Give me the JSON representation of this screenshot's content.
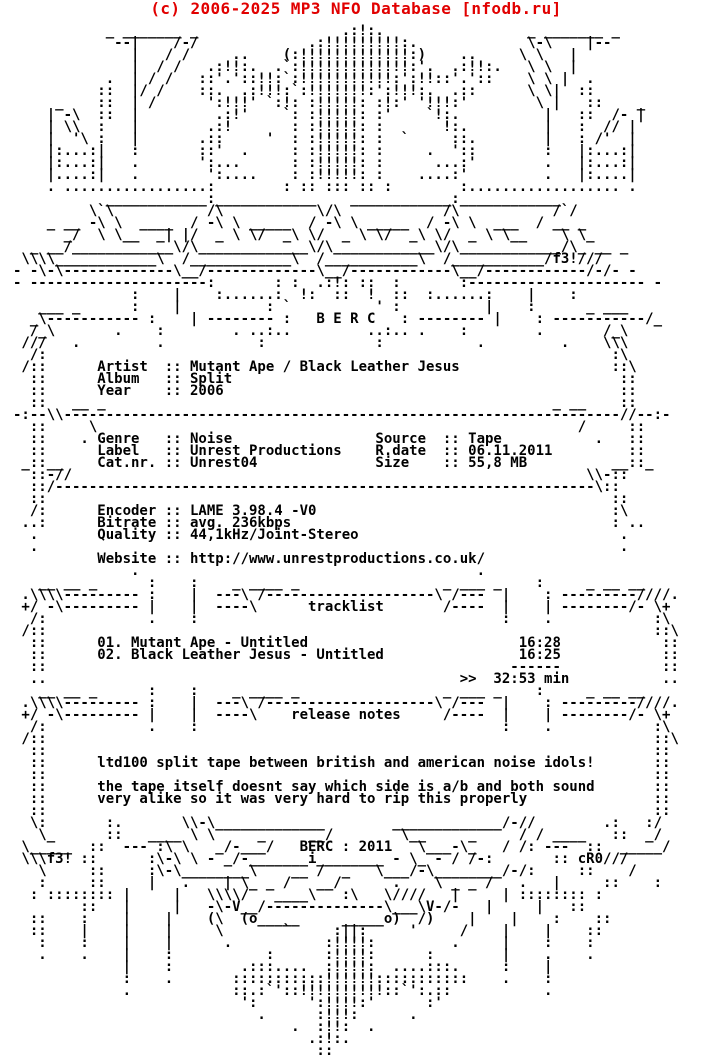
{
  "site_header": {
    "text": "(c) 2006-2025 MP3 NFO Database [nfodb.ru]",
    "color": "#e10000"
  },
  "group": {
    "name": "B E R C",
    "footer_tag": "BERC : 2011",
    "ascii_art_by": "f3!",
    "nfo_by": "cR0"
  },
  "release_info": {
    "artist": "Mutant Ape / Black Leather Jesus",
    "album": "Split",
    "year": "2006",
    "genre": "Noise",
    "label": "Unrest Productions",
    "cat_nr": "Unrest04",
    "source": "Tape",
    "release_date": "06.11.2011",
    "size": "55,8 MB",
    "encoder": "LAME 3.98.4 -V0",
    "bitrate": "avg. 236kbps",
    "quality": "44,1kHz/Joint-Stereo",
    "website": "http://www.unrestproductions.co.uk/"
  },
  "tracklist": {
    "section_title": "tracklist",
    "tracks": [
      {
        "number": "01.",
        "title": "Mutant Ape - Untitled",
        "duration": "16:28"
      },
      {
        "number": "02.",
        "title": "Black Leather Jesus - Untitled",
        "duration": "16:25"
      }
    ],
    "total_duration": "32:53 min"
  },
  "release_notes": {
    "section_title": "release notes",
    "lines": [
      "ltd100 split tape between british and american noise idols!",
      "the tape itself doesnt say which side is a/b and both sound",
      "very alike so it was very hard to rip this properly"
    ]
  },
  "nfo_ascii": [
    "           _ _______ _                 .:!:.                 _ _______ _",
    "            --|    /-/             .:!!!!!!!!!:.             \\-\\    |--",
    "              |   / /     ..    (:!!!!!!!!!!!!!:)    ..     \\ \\   |",
    "              |  / /   .:!!:.  .`:!!!!!!!!!!!!!:'.  .:!!:.   \\ \\  |",
    "           .  | / /   ::'.'::!!:`:!!!!!!!!!!!:':!!::'.'::    \\ \\ |  .",
    "          ::  |/ /    ::.  .:!!!:`:!!!!!!!:':!!!:.  .::      \\ \\|  ::",
    "     _    ::  | /      ':!!!' `:!: :!!!!!: :!:' '!!!:'        \\ |   ::    _",
    "    | -\\  ::  |         .:!'    `: :!!!!!: :'    `!:.          |   ::  /- |",
    "    | \\\\  :   |        .:!       : :!!!!!: :       !:.         |   :  // |",
    "    |  '\\ :   |       .::     '  : :!!!!!: :  `     ::.        |   : /'  |",
    "    |:...:|   :       ::'  .     : :!!!!!: :     .  '::        :   |:...:|",
    "    |:...:|   .       ':...      : :!!!!!: :      ...:'        .   |:...:|",
    "    |....:|   .        ':....    : :!!!!!: :    ....:'         .   |:....|",
    "    . .................:        : :: ::: :: :        :.................. .",
    "           ____________:____________    ____________:____________",
    "         \\`\\           /\\           \\/\\            /\\           /`/",
    "    _ __ -\\ \\  ____  / -\\ \\ _____  / -\\ \\ _____  / -\\ \\  ___  / __ _",
    "      _/  \\ \\__  _| |/  _ \\ \\/  _\\ \\/  _ \\ \\/  _\\ \\/  _ \\ \\__    \\ \\_",
    "  _ __/____________\\/\\_____________\\/\\____________\\/\\____________/\\_ __ _",
    " \\\\\\\\____________\\  /____________\\  /___________\\  /___________/f3!///",
    "- -\\-\\-------------\\__/-------------\\__/------------\\__/------------/-/- -",
    "- ---------------------:       : :  .:!: ::  :       :--------------------- -",
    "              :    |    :......:  !:  ::  !  ::  :......:    |    :",
    "   ___ _      :    |          : `          ' :          |    :      _ ___",
    "  _\\----------- :    | -------- :   B E R C   : -------- |    : -----------/_",
    "  /_\\       .    :        . ..:..         ..:.. .    :        .       /_\\",
    " ///   .         .           :             :           .         .    \\\\\\",
    "  /:                                                                   :\\",
    " /::      Artist  :: Mutant Ape / Black Leather Jesus                  ::\\",
    "  ::      Album   :: Split                                              ::",
    "  ::      Year    :: 2006                                               ::",
    "  ::   __ _                                                     _ __    ::",
    "-:--\\\\------------------------------------------------------------------//--:-",
    "  ::     \\                                                         /     ::",
    "  ::    . Genre   :: Noise                 Source  :: Tape           .   ::",
    "  ::      Label   :: Unrest Productions    R.date  :: 06.11.2011         ::",
    " _::__    Cat.nr. :: Unrest04              Size    :: 55,8 MB          __::_",
    "  ::-//                                                             \\\\-::",
    "  ::/----------------------------------------------------------------\\::",
    "  ::                                                                   ::",
    "  /:      Encoder :: LAME 3.98.4 -V0                                   :\\",
    " ..:      Bitrate :: avg. 236kbps                                      : ..",
    "  .       Quality :: 44,1kHz/Joint-Stereo                               .",
    "  .                                                                     .",
    "          Website :: http://www.unrestproductions.co.uk/",
    "              .                                        .",
    "   __ __ _      :    :    _ ____ _                 _ ___ _    :     _ __ __",
    " .\\\\\\\\--------- :    |  ---\\ /--------------------\\ /---  |    : ---------////.",
    " +/ -\\--------- |    |  ----\\      tracklist       /----  |    | --------/- \\+",
    "  /:            .    :                                    :    .            :\\",
    " /::                                                                        ::\\",
    "  ::      01. Mutant Ape - Untitled                         16:28            ::",
    "  ::      02. Black Leather Jesus - Untitled                16:25            ::",
    "  ::                                                       ------            ::",
    "  ..                                                 >>  32:53 min           ..",
    "   __ __ _      :    :    _ ____ _                 _ ___ _    :     _ __ __",
    " .\\\\\\\\--------- :    |  ---\\ /--------------------\\ /---  |    : ---------////.",
    " +/ -\\--------- |    |  ----\\    release notes     /----  |    | --------/- \\+",
    "  /:            .    :                                    :    .            :\\",
    " /::                                                                        ::\\",
    "  ::                                                                        ::",
    "  ::      ltd100 split tape between british and american noise idols!       ::",
    "  ::                                                                        ::",
    "  ::      the tape itself doesnt say which side is a/b and both sound       ::",
    "  ::      very alike so it was very hard to rip this properly               ::",
    "  ::                                                                        ::",
    "  \\:       :.       \\\\-\\_____________        _____________/-//        .:   :/",
    "   \\_      ::   ____ \\ \\     _     __/        \\__     _     / / ____   ::  _/",
    " \\_____  ::  --- :\\ \\   _/-___/   BERC : 2011   \\___-\\_   / /: ---  ::  _____/",
    " \\\\\\f3! ::      :\\-\\ \\ - _/-_______i________ - \\_ - / /-:       :: cR0///",
    "   \\     ::     :\\-\\________\\    __ /  _   \\___/-\\________/-/:     ::    /",
    "   :     ::     |   .    | \\_ _ /   __/      .    \\ _ _ /   .   |     ::    :",
    "  : :::::::: |     |   \\\\\\\\/   ____\\   :\\   \\////   |     | :::::::: :",
    "        ::   |     |   -\\-V__/--------------\\___\\V-/-   |     |   ::",
    "  ::    :    |    |    (\\  (o_____     _____o)  /)    |    |    :    ::",
    "  ::    |    |    |     \\       `     :||:     '     /    |    |    ::",
    "   :    :    |    |      .           :!!!!:         .     |    :    :",
    "   .    .    |    :           :      :!!!!:      :        |    .    .",
    "             |    :        .:::....  :!!!!:  ....:::.     :    |",
    "             :    .       :::::::::::!!!!!!:::::::::::    .    :",
    "             .            ::.:`'::!!!!!!!!!!::`':.::           .",
    "                           ':      ':!!!!:'      :'",
    "                             .      :!!!:      .",
    "                                 .  :!!:  .",
    "                                   .:!:.",
    "                                    ::"
  ]
}
